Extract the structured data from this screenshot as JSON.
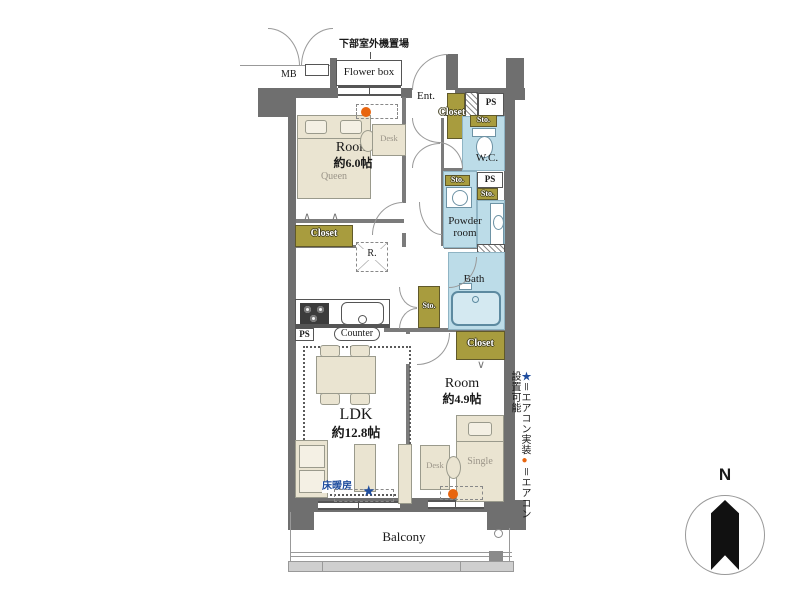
{
  "colors": {
    "wall": "#6f6f6f",
    "wet_room": "#bcdce8",
    "storage_olive": "#a89c3e",
    "furniture": "#eae4d1",
    "accent_blue": "#1f4d9e",
    "accent_orange": "#e8650f"
  },
  "labels": {
    "outdoor_unit": "下部室外機置場",
    "mb": "MB",
    "flower_box": "Flower box",
    "ent": "Ent.",
    "closet_entry": "Closet",
    "ps_top": "PS",
    "sto_wc": "Sto.",
    "wc": "W.C.",
    "ps_mid": "PS",
    "sto_powder": "Sto.",
    "sto_mid": "Sto.",
    "powder_room": "Powder room",
    "bath": "Bath",
    "sto_hall": "Sto.",
    "closet_room1": "Closet",
    "closet_room2": "Closet",
    "fridge": "R.",
    "ps_kitchen": "PS",
    "counter": "Counter",
    "room1_name": "Room",
    "room1_size": "約6.0帖",
    "room1_bed": "Queen",
    "room1_desk": "Desk",
    "room2_name": "Room",
    "room2_size": "約4.9帖",
    "room2_bed": "Single",
    "room2_desk": "Desk",
    "ldk_name": "LDK",
    "ldk_size": "約12.8帖",
    "floor_heating": "床暖房",
    "ldk_star": "★",
    "balcony": "Balcony",
    "compass_north": "N"
  },
  "legend": {
    "star_symbol": "★",
    "star_label": "＝エアコン実装",
    "dot_symbol": "●",
    "dot_label": "＝エアコン設置可能"
  }
}
